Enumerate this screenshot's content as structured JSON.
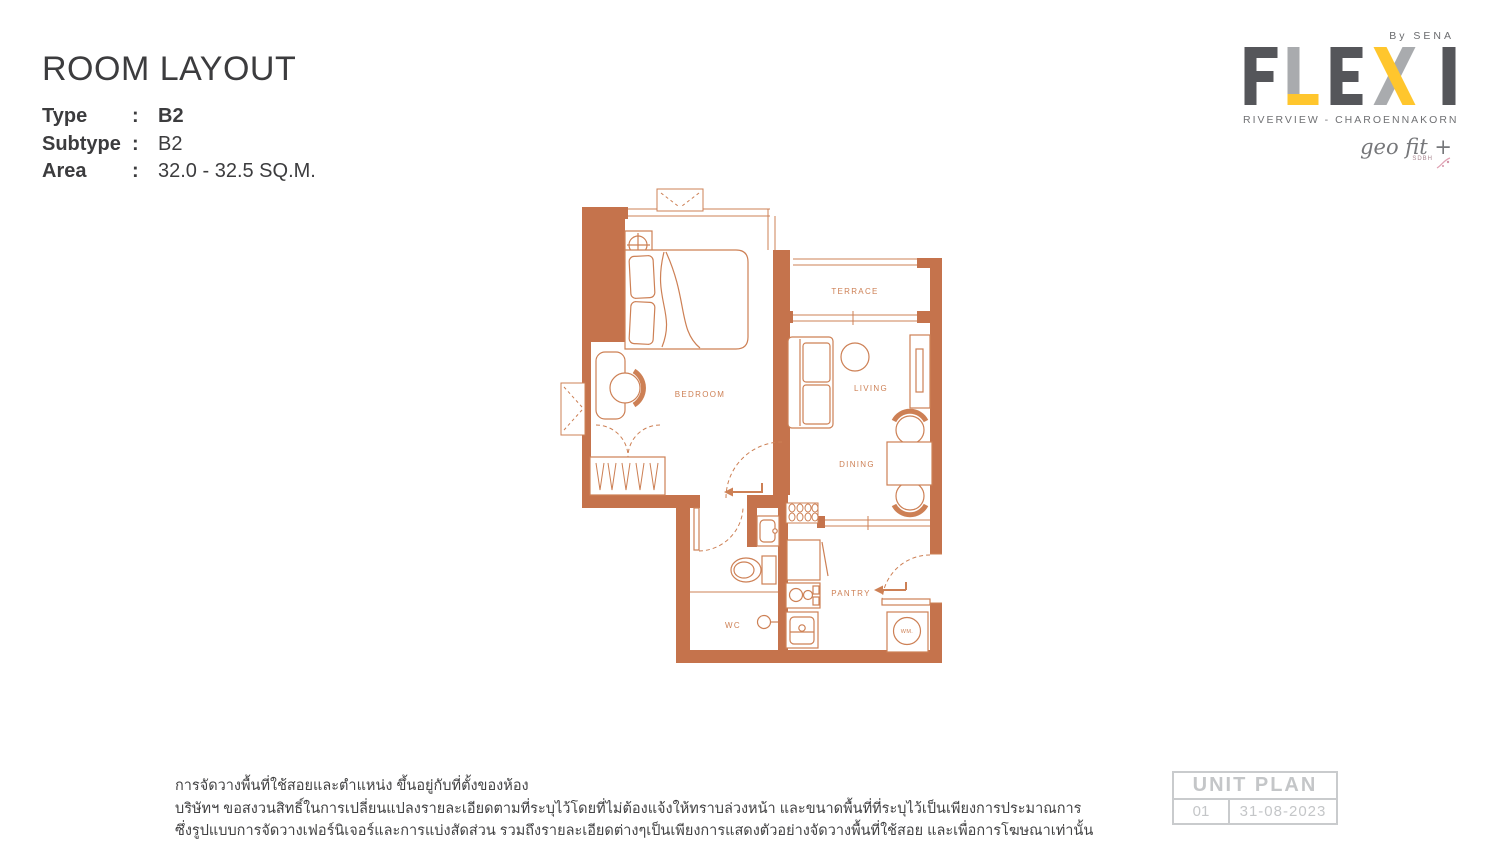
{
  "header": {
    "title": "ROOM LAYOUT",
    "specs": [
      {
        "label": "Type",
        "colon": ":",
        "value": "B2"
      },
      {
        "label": "Subtype",
        "colon": ":",
        "value": "B2"
      },
      {
        "label": "Area",
        "colon": ":",
        "value": "32.0 - 32.5 SQ.M."
      }
    ]
  },
  "logo": {
    "by_line": "By SENA",
    "brand": "FLEXI",
    "subtitle": "RIVERVIEW - CHAROENNAKORN",
    "geo_fit": "geo fit +",
    "geo_fit_sub": "SDBH",
    "colors": {
      "dark": "#55565a",
      "gray": "#a9abae",
      "yellow": "#ffc62d"
    }
  },
  "floor_plan": {
    "accent_color": "#c5734c",
    "line_color": "#cd8055",
    "rooms": {
      "bedroom": "BEDROOM",
      "terrace": "TERRACE",
      "living": "LIVING",
      "dining": "DINING",
      "pantry": "PANTRY",
      "wc": "WC",
      "wm": "WM."
    }
  },
  "footer": {
    "disclaimer_lines": [
      "การจัดวางพื้นที่ใช้สอยและตำแหน่ง ขึ้นอยู่กับที่ตั้งของห้อง",
      "บริษัทฯ ขอสงวนสิทธิ์ในการเปลี่ยนแปลงรายละเอียดตามที่ระบุไว้โดยที่ไม่ต้องแจ้งให้ทราบล่วงหน้า และขนาดพื้นที่ที่ระบุไว้เป็นเพียงการประมาณการ",
      "ซึ่งรูปแบบการจัดวางเฟอร์นิเจอร์และการแบ่งสัดส่วน รวมถึงรายละเอียดต่างๆเป็นเพียงการแสดงตัวอย่างจัดวางพื้นที่ใช้สอย และเพื่อการโฆษณาเท่านั้น"
    ],
    "unit_plan": {
      "title": "UNIT PLAN",
      "number": "01",
      "date": "31-08-2023"
    }
  }
}
